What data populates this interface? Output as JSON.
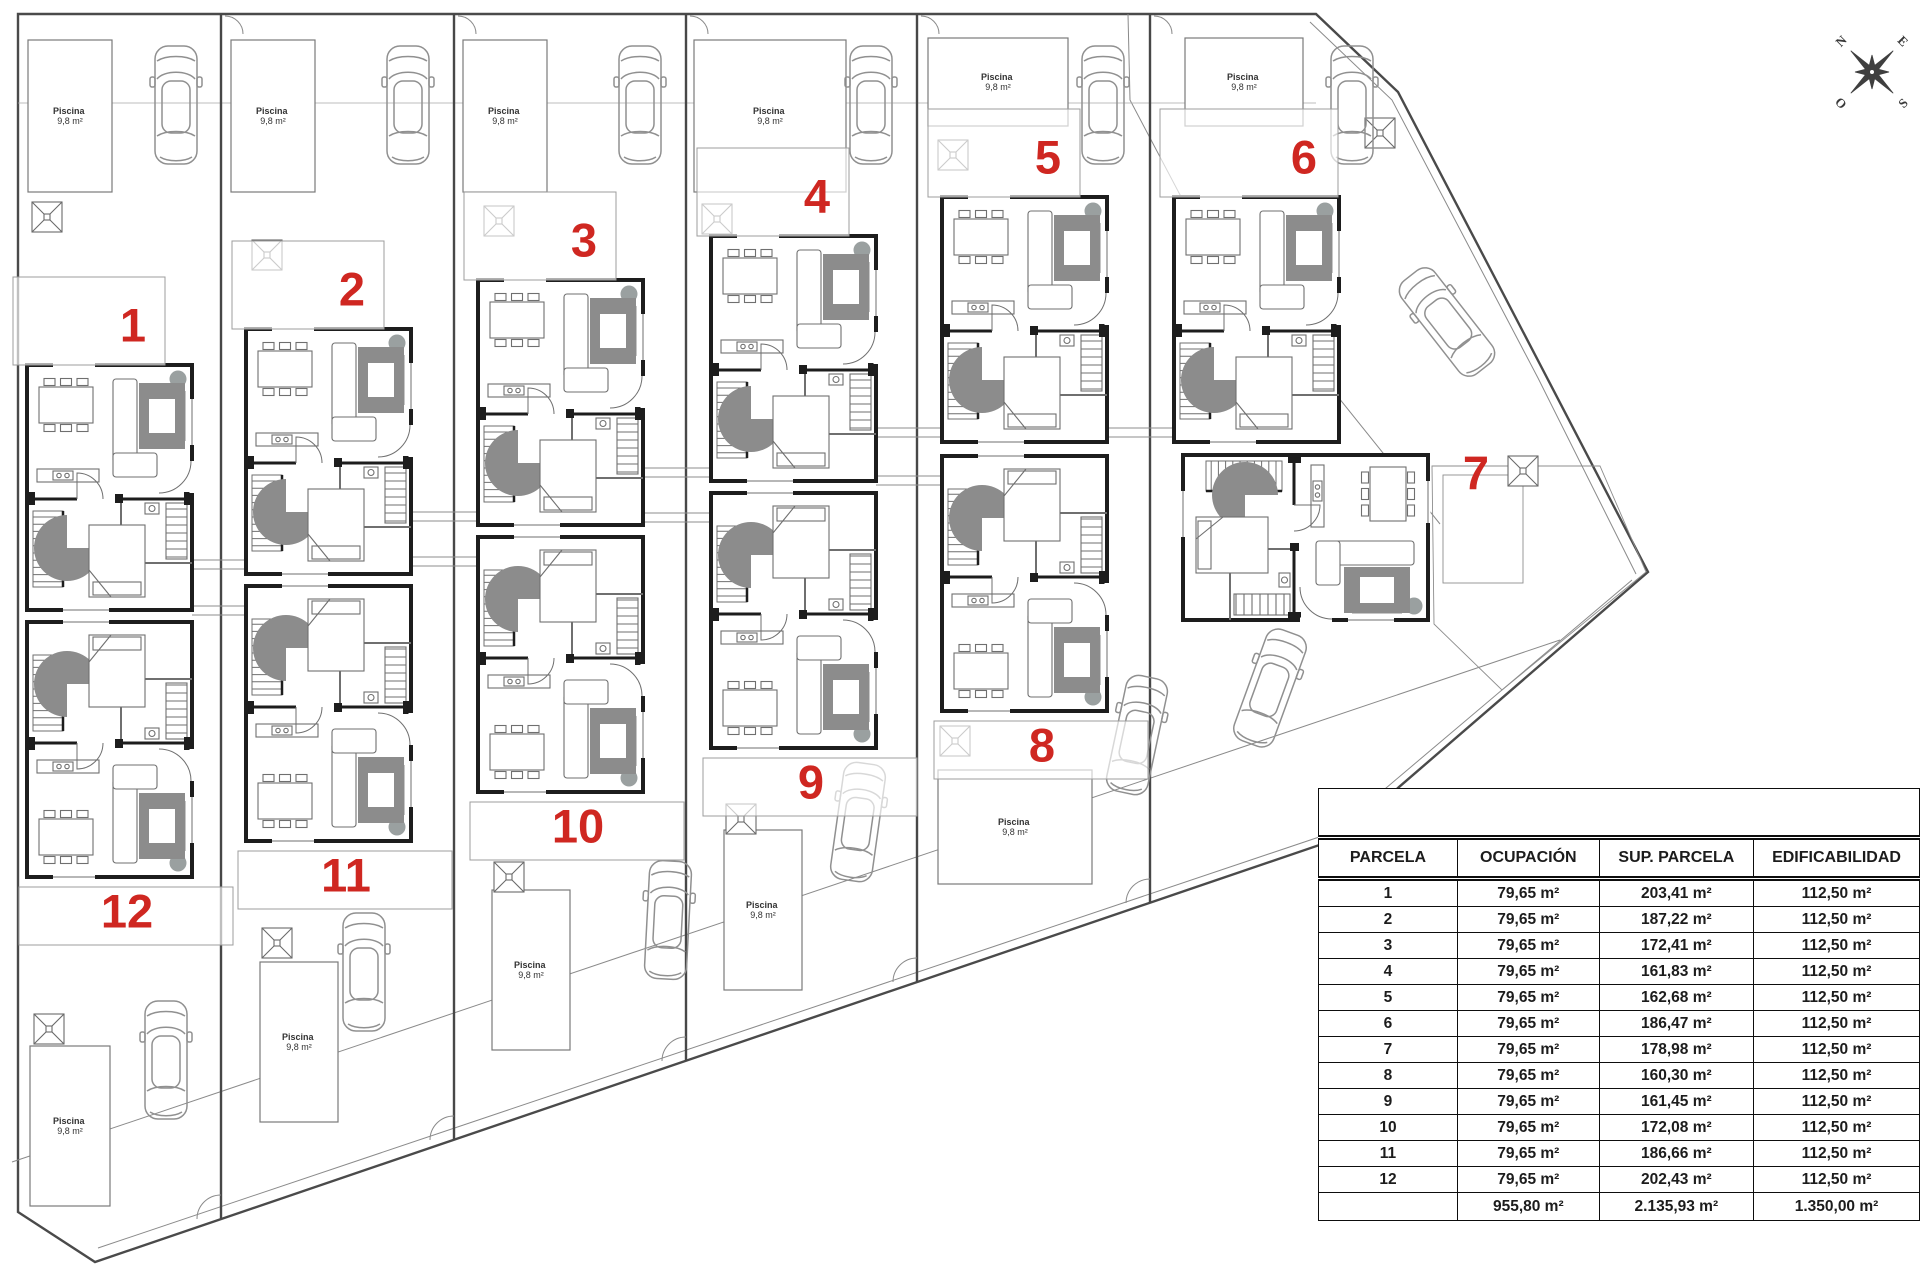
{
  "colors": {
    "red": "#cf2721",
    "wall": "#1d1d1d",
    "line": "#6f6f6f",
    "car": "#909090",
    "furniture": "#8c8c8c",
    "boundary": "#4a4a4a",
    "thin": "#8a8a8a",
    "background": "#ffffff"
  },
  "compass": {
    "north": "N",
    "east": "E",
    "south": "S",
    "west": "O"
  },
  "plan": {
    "parcel_numbers": [
      "1",
      "2",
      "3",
      "4",
      "5",
      "6",
      "7",
      "8",
      "9",
      "10",
      "11",
      "12"
    ],
    "pool_label_line1": "Piscina",
    "pool_label_line2": "9,8 m²"
  },
  "table": {
    "title": "",
    "headers": [
      "PARCELA",
      "OCUPACIÓN",
      "SUP. PARCELA",
      "EDIFICABILIDAD"
    ],
    "rows": [
      [
        "1",
        "79,65 m²",
        "203,41 m²",
        "112,50 m²"
      ],
      [
        "2",
        "79,65 m²",
        "187,22 m²",
        "112,50 m²"
      ],
      [
        "3",
        "79,65 m²",
        "172,41 m²",
        "112,50 m²"
      ],
      [
        "4",
        "79,65 m²",
        "161,83 m²",
        "112,50 m²"
      ],
      [
        "5",
        "79,65 m²",
        "162,68 m²",
        "112,50 m²"
      ],
      [
        "6",
        "79,65 m²",
        "186,47 m²",
        "112,50 m²"
      ],
      [
        "7",
        "79,65 m²",
        "178,98 m²",
        "112,50 m²"
      ],
      [
        "8",
        "79,65 m²",
        "160,30 m²",
        "112,50 m²"
      ],
      [
        "9",
        "79,65 m²",
        "161,45 m²",
        "112,50 m²"
      ],
      [
        "10",
        "79,65 m²",
        "172,08 m²",
        "112,50 m²"
      ],
      [
        "11",
        "79,65 m²",
        "186,66 m²",
        "112,50 m²"
      ],
      [
        "12",
        "79,65 m²",
        "202,43 m²",
        "112,50 m²"
      ]
    ],
    "totals": [
      "",
      "955,80 m²",
      "2.135,93 m²",
      "1.350,00 m²"
    ]
  }
}
